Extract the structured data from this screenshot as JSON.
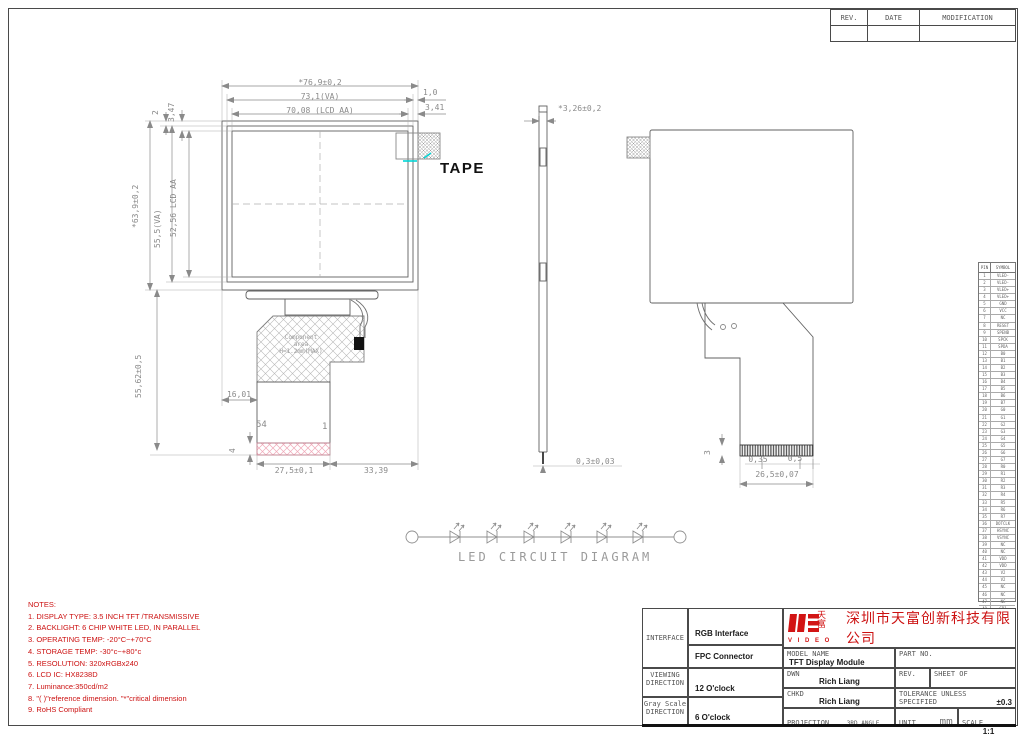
{
  "revision": {
    "headers": [
      "REV.",
      "DATE",
      "MODIFICATION"
    ]
  },
  "labels": {
    "tape": "TAPE",
    "led_caption": "LED CIRCUIT DIAGRAM",
    "component_line1": "Component",
    "component_line2": "area",
    "component_line3": "H=1.2mm(MAX)",
    "pin_last": "54",
    "pin_first": "1"
  },
  "dims": {
    "front_width_outer": "*76,9±0,2",
    "front_width_va": "73,1(VA)",
    "front_width_aa": "70,08 (LCD AA)",
    "front_right_small": "1,0",
    "front_right_small2": "3,41",
    "front_topleft_small": "2",
    "front_topleft_small2": "3,47",
    "front_height_outer": "*63,9±0,2",
    "front_height_va": "55,5(VA)",
    "front_height_aa": "52,56 LCD AA",
    "fpc_height": "55,62±0,5",
    "fpc_offset": "16,01",
    "fpc_width": "27,5±0,1",
    "fpc_right": "33,39",
    "fpc_strip": "4",
    "side_thickness": "*3,26±0,2",
    "side_bottom": "0,3±0,03",
    "rear_finger_width": "0,35",
    "rear_finger_pitch": "0,5",
    "rear_conn_width": "26,5±0,07",
    "rear_strip": "3"
  },
  "notes": {
    "title": "NOTES:",
    "items": [
      "1. DISPLAY TYPE: 3.5  INCH TFT /TRANSMISSIVE",
      "2. BACKLIGHT: 6 CHIP WHITE LED, IN PARALLEL",
      "3. OPERATING TEMP: -20°C~+70°C",
      "4. STORAGE TEMP: -30°c~+80°c",
      "5. RESOLUTION: 320xRGBx240",
      "6. LCD IC: HX8238D",
      "7.  Luminance:350cd/m2",
      "8. \"( )\"reference dimension. \"*\"critical dimension",
      "9. RoHS Compliant"
    ]
  },
  "pin_table": {
    "headers": [
      "PIN",
      "SYMBOL"
    ],
    "rows": [
      [
        "1",
        "VLED-"
      ],
      [
        "2",
        "VLED-"
      ],
      [
        "3",
        "VLED+"
      ],
      [
        "4",
        "VLED+"
      ],
      [
        "5",
        "GND"
      ],
      [
        "6",
        "VCC"
      ],
      [
        "7",
        "NC"
      ],
      [
        "8",
        "RESET"
      ],
      [
        "9",
        "SPENB"
      ],
      [
        "10",
        "SPCK"
      ],
      [
        "11",
        "SPDA"
      ],
      [
        "12",
        "B0"
      ],
      [
        "13",
        "B1"
      ],
      [
        "14",
        "B2"
      ],
      [
        "15",
        "B3"
      ],
      [
        "16",
        "B4"
      ],
      [
        "17",
        "B5"
      ],
      [
        "18",
        "B6"
      ],
      [
        "19",
        "B7"
      ],
      [
        "20",
        "G0"
      ],
      [
        "21",
        "G1"
      ],
      [
        "22",
        "G2"
      ],
      [
        "23",
        "G3"
      ],
      [
        "24",
        "G4"
      ],
      [
        "25",
        "G5"
      ],
      [
        "26",
        "G6"
      ],
      [
        "27",
        "G7"
      ],
      [
        "28",
        "R0"
      ],
      [
        "29",
        "R1"
      ],
      [
        "30",
        "R2"
      ],
      [
        "31",
        "R3"
      ],
      [
        "32",
        "R4"
      ],
      [
        "33",
        "R5"
      ],
      [
        "34",
        "R6"
      ],
      [
        "35",
        "R7"
      ],
      [
        "36",
        "DOTCLK"
      ],
      [
        "37",
        "HSYNC"
      ],
      [
        "38",
        "VSYNC"
      ],
      [
        "39",
        "NC"
      ],
      [
        "40",
        "NC"
      ],
      [
        "41",
        "VDD"
      ],
      [
        "42",
        "VDD"
      ],
      [
        "43",
        "V2"
      ],
      [
        "44",
        "V2"
      ],
      [
        "45",
        "NC"
      ],
      [
        "46",
        "NC"
      ],
      [
        "47",
        "NC"
      ],
      [
        "48",
        "GP1"
      ],
      [
        "49",
        "GP1"
      ],
      [
        "50",
        "DTB"
      ],
      [
        "51",
        "NC"
      ],
      [
        "52",
        "DSDS"
      ],
      [
        "53",
        "GND"
      ],
      [
        "54",
        "GND"
      ]
    ]
  },
  "tb": {
    "interface_label": "INTERFACE",
    "interface_1": "RGB Interface",
    "interface_2": "FPC Connector",
    "viewing_label1": "VIEWING",
    "viewing_label2": "DIRECTION",
    "viewing_value": "12 O'clock",
    "gray_label1": "Gray Scale",
    "gray_label2": "DIRECTION",
    "gray_value": "6 O'clock",
    "model_label": "MODEL NAME",
    "model_value": "TFT Display Module",
    "part_label": "PART NO.",
    "dwn_label": "DWN",
    "dwn_value": "Rich Liang",
    "chkd_label": "CHKD",
    "chkd_value": "Rich Liang",
    "rev_label": "REV.",
    "sheet_label": "SHEET OF",
    "tol_label1": "TOLERANCE UNLESS",
    "tol_label2": "SPECIFIED",
    "tol_value": "±0.3",
    "proj_label": "PROJECTION",
    "proj_value": "3RD ANGLE",
    "unit_label": "UNIT",
    "unit_value": "mm",
    "scale_label": "SCALE",
    "scale_value": "1:1"
  },
  "company": {
    "name": "深圳市天富创新科技有限公司",
    "logo_line1": "天",
    "logo_line2": "富",
    "logo_sub": "V I D E O"
  },
  "colors": {
    "note_red": "#cc1111",
    "logo_red": "#d21414",
    "dim_gray": "#8a8a8a",
    "line_gray": "#606060",
    "tape_cyan": "#00d5d5",
    "strip_pink": "#f0a8b8"
  }
}
